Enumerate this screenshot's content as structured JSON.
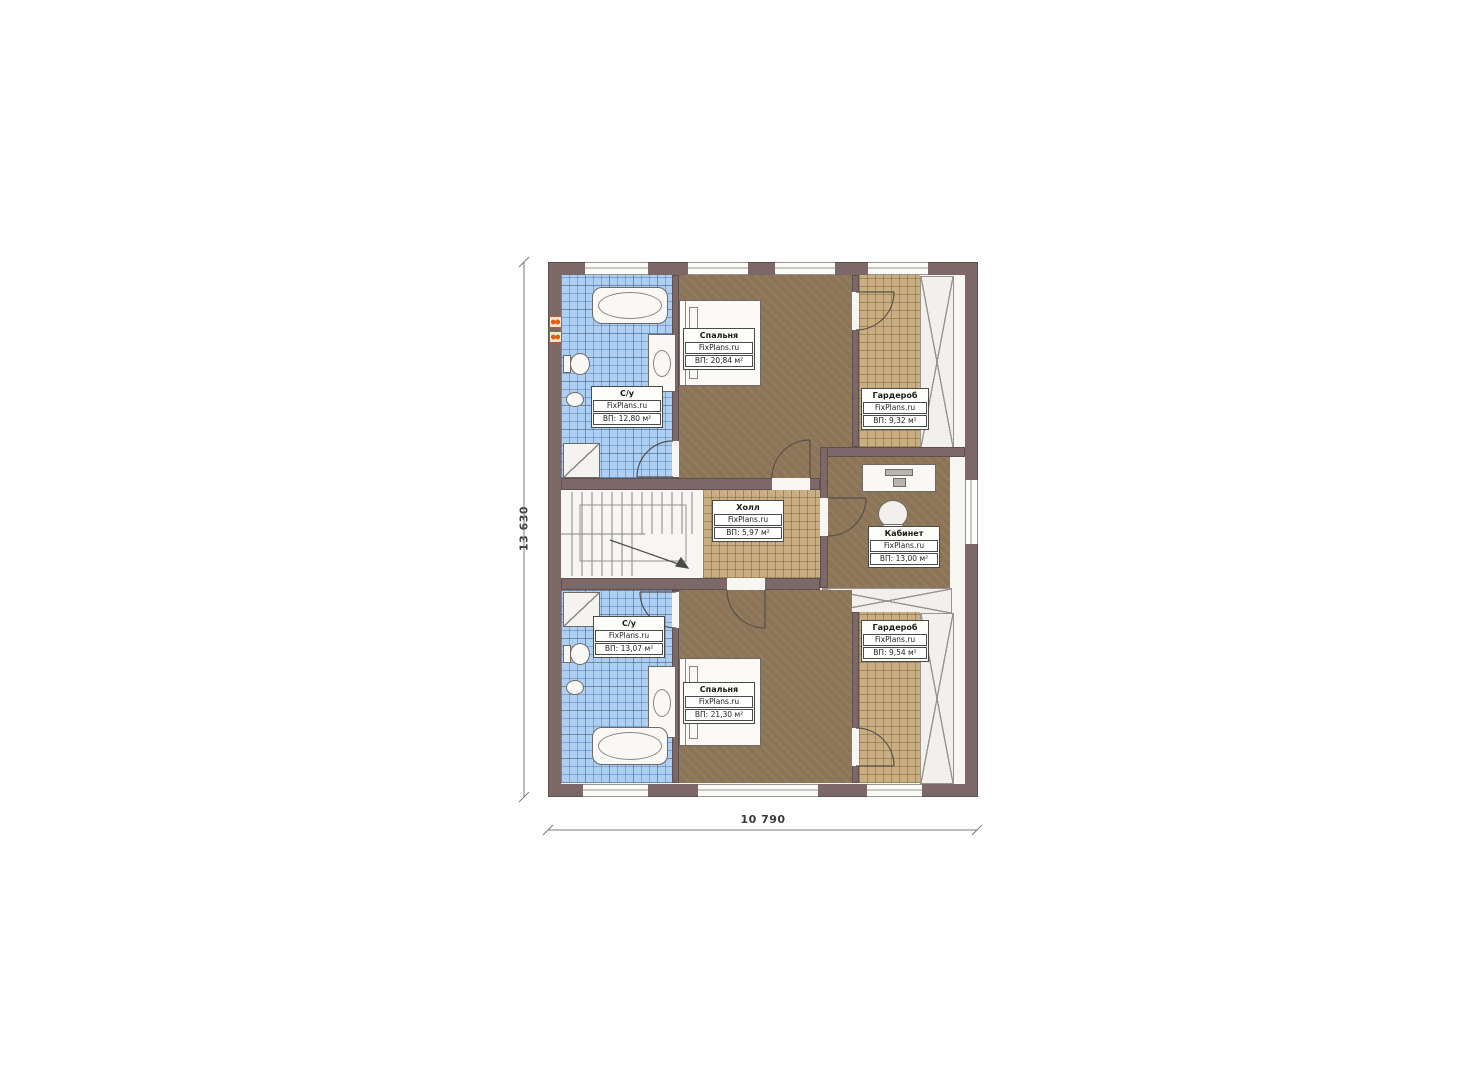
{
  "plan": {
    "brand": "FixPlans.ru",
    "dimensions": {
      "height": "13 630",
      "width": "10 790"
    },
    "rooms": [
      {
        "id": "bedroom-top",
        "name": "Спальня",
        "brand": "FixPlans.ru",
        "area": "ВП: 20,84 м²"
      },
      {
        "id": "bath-top",
        "name": "С/у",
        "brand": "FixPlans.ru",
        "area": "ВП: 12,80 м²"
      },
      {
        "id": "wardrobe-top",
        "name": "Гардероб",
        "brand": "FixPlans.ru",
        "area": "ВП: 9,32 м²"
      },
      {
        "id": "hall",
        "name": "Холл",
        "brand": "FixPlans.ru",
        "area": "ВП: 5,97 м²"
      },
      {
        "id": "office",
        "name": "Кабинет",
        "brand": "FixPlans.ru",
        "area": "ВП: 13,00 м²"
      },
      {
        "id": "bath-bottom",
        "name": "С/у",
        "brand": "FixPlans.ru",
        "area": "ВП: 13,07 м²"
      },
      {
        "id": "bedroom-bottom",
        "name": "Спальня",
        "brand": "FixPlans.ru",
        "area": "ВП: 21,30 м²"
      },
      {
        "id": "wardrobe-bottom",
        "name": "Гардероб",
        "brand": "FixPlans.ru",
        "area": "ВП: 9,54 м²"
      }
    ],
    "colors": {
      "wall": "#7c6967",
      "bedroom_floor": "#8c7456",
      "tile_tan": "#c9ae82",
      "tile_blue": "#accff2",
      "accent_orange": "#e2600f"
    }
  }
}
